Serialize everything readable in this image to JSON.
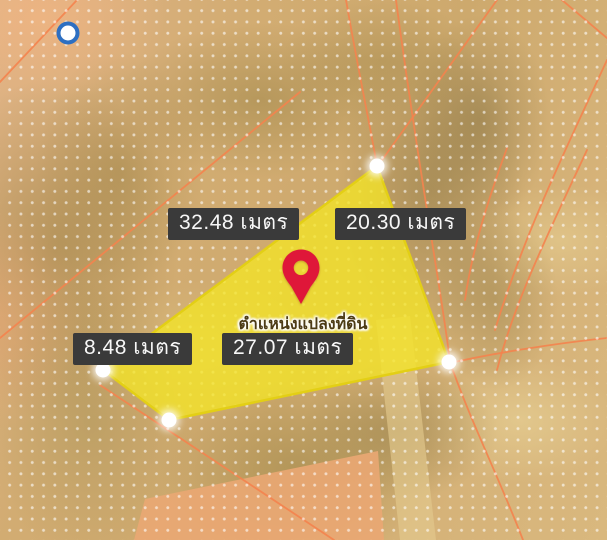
{
  "view": {
    "type": "satellite-map-with-parcel-overlay",
    "dot_grid_overlay": true
  },
  "parcel": {
    "pin_label": "ตำแหน่งแปลงที่ดิน",
    "vertex_count": 4,
    "measurements": [
      {
        "side": "northwest",
        "label": "32.48 เมตร",
        "value": "32.48",
        "unit": "เมตร"
      },
      {
        "side": "northeast",
        "label": "20.30 เมตร",
        "value": "20.30",
        "unit": "เมตร"
      },
      {
        "side": "west",
        "label": "8.48 เมตร",
        "value": "8.48",
        "unit": "เมตร"
      },
      {
        "side": "south",
        "label": "27.07 เมตร",
        "value": "27.07",
        "unit": "เมตร"
      }
    ]
  },
  "markers": {
    "location_pin": "red-map-pin",
    "point_marker": "blue-circle-point"
  },
  "colors": {
    "parcel-fill": "#f4e426",
    "parcel-stroke": "#e3cf15",
    "pin-red": "#df1739",
    "line-orange": "#f4834e",
    "label-bg": "#3a3a3a",
    "label-text": "#f7f7f7",
    "marker-blue": "#2d6fc2",
    "map-base": "#d2ac72"
  }
}
